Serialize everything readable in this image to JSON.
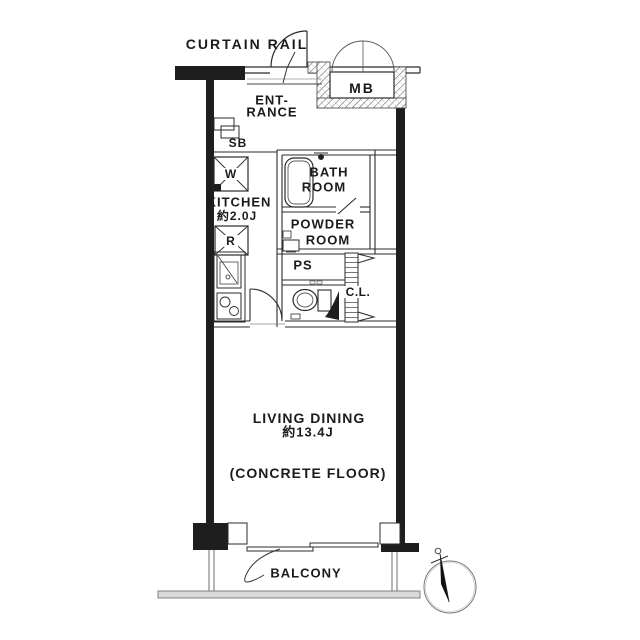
{
  "plan": {
    "labels": {
      "curtain_rail": "CURTAIN RAIL",
      "meter_box": "MB",
      "entrance_line1": "ENT-",
      "entrance_line2": "RANCE",
      "shoe_box": "SB",
      "kitchen": "KITCHEN",
      "kitchen_size": "約2.0J",
      "washer": "W",
      "refrigerator": "R",
      "bath_line1": "BATH",
      "bath_line2": "ROOM",
      "powder_line1": "POWDER",
      "powder_line2": "ROOM",
      "pipe_space": "PS",
      "closet": "C.L.",
      "living_line1": "LIVING DINING",
      "living_size": "約13.4J",
      "floor_note": "(CONCRETE FLOOR)",
      "balcony": "BALCONY"
    },
    "rooms": [
      {
        "name": "ENTRANCE"
      },
      {
        "name": "KITCHEN",
        "size": "約2.0J"
      },
      {
        "name": "BATH ROOM"
      },
      {
        "name": "POWDER ROOM"
      },
      {
        "name": "LIVING DINING",
        "size": "約13.4J",
        "floor": "(CONCRETE FLOOR)"
      },
      {
        "name": "BALCONY"
      }
    ],
    "colors": {
      "wall": "#1e1e1e",
      "line": "#2b2b2b",
      "text": "#1b1b1b",
      "balcony_gray": "#808080",
      "background": "#ffffff"
    }
  }
}
